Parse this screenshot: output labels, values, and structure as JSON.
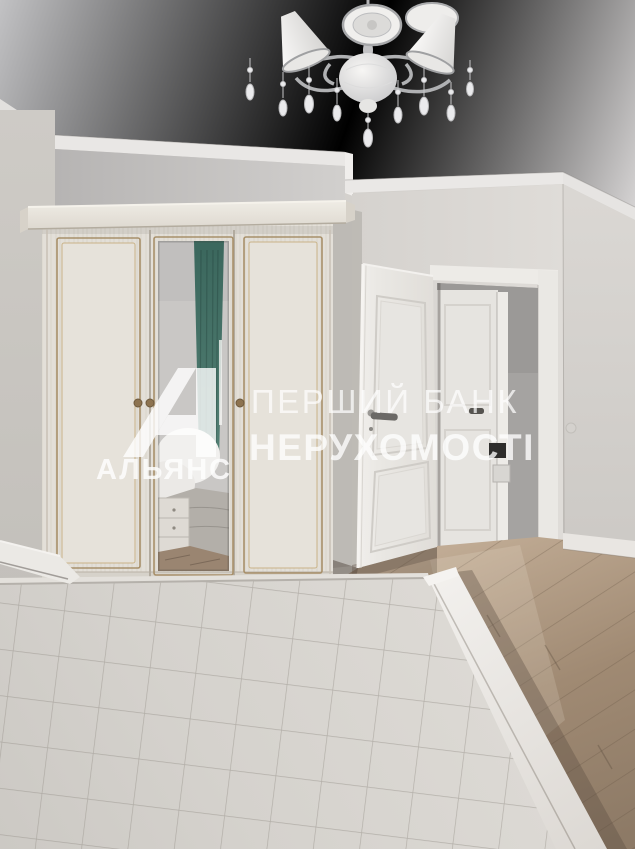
{
  "photo": {
    "kind": "real-estate-interior-photo",
    "room": "bedroom",
    "objects": [
      "crystal-chandelier",
      "three-door-wardrobe-with-mirror",
      "mirror-reflection-teal-curtain",
      "open-white-door",
      "hallway-with-second-door",
      "wood-laminate-floor",
      "quilted-bed",
      "white-bed-rail"
    ]
  },
  "watermark": {
    "line1": "ПЕРШИЙ БАНК",
    "line2": "НЕРУХОМОСТІ",
    "logo_text": "АЛЬЯНС",
    "logo_icon": "alliance-a-logo",
    "text_color": "#ffffff"
  },
  "palette": {
    "ceiling": "#cbcbcd",
    "wall_light": "#dbd8d4",
    "wall_shaded": "#bdbbba",
    "wardrobe_body": "#e5e1da",
    "wardrobe_trim": "#a8906a",
    "door_white": "#eceae6",
    "hallway_wall": "#a5a3a1",
    "floor_wood": "#a18b75",
    "bed_quilt": "#d7d4cf",
    "curtain_teal": "#47736a"
  }
}
